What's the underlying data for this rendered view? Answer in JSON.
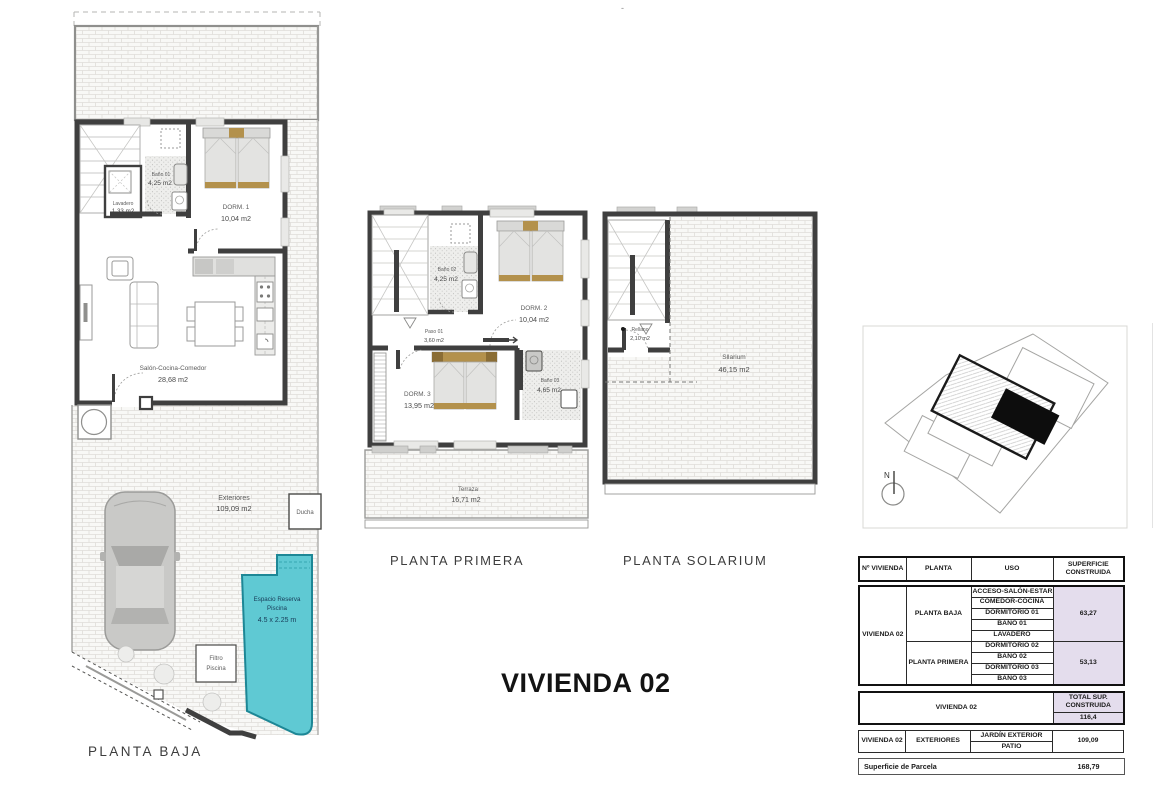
{
  "page": {
    "title": "VIVIENDA 02",
    "top_mark": "-"
  },
  "planta_baja": {
    "label": "PLANTA BAJA",
    "bano01_name": "Baño 01",
    "bano01_area": "4,25 m2",
    "lavadero_name": "Lavadero",
    "lavadero_area": "1,33 m2",
    "dorm1_name": "DORM. 1",
    "dorm1_area": "10,04 m2",
    "salon_name": "Salón-Cocina-Comedor",
    "salon_area": "28,68 m2",
    "exteriores_name": "Exteriores",
    "exteriores_area": "109,09 m2",
    "ducha_label": "Ducha",
    "piscina_line1": "Espacio Reserva",
    "piscina_line2": "Piscina",
    "piscina_dims": "4.5 x 2.25 m",
    "filtro_line1": "Filtro",
    "filtro_line2": "Piscina"
  },
  "planta_primera": {
    "label": "PLANTA PRIMERA",
    "bano02_name": "Baño 02",
    "bano02_area": "4,25 m2",
    "dorm2_name": "DORM. 2",
    "dorm2_area": "10,04 m2",
    "paso_name": "Paso 01",
    "paso_area": "3,60 m2",
    "dorm3_name": "DORM. 3",
    "dorm3_area": "13,95 m2",
    "bano03_name": "Baño 03",
    "bano03_area": "4,65 m2",
    "terraza_name": "Terraza",
    "terraza_area": "16,71 m2"
  },
  "planta_solarium": {
    "label": "PLANTA SOLARIUM",
    "rellano_name": "Rellano",
    "rellano_area": "2,10 m2",
    "solarium_name": "Sllarium",
    "solarium_area": "46,15 m2"
  },
  "site_plan": {
    "north_label": "N"
  },
  "table": {
    "headers": {
      "vivienda": "Nº VIVIENDA",
      "planta": "PLANTA",
      "uso": "USO",
      "superficie": "SUPERFICIE CONSTRUIDA"
    },
    "vivienda_id": "VIVIENDA 02",
    "baja_label": "PLANTA BAJA",
    "baja_usos": [
      "ACCESO-SALÓN-ESTAR",
      "COMEDOR-COCINA",
      "DORMITORIO 01",
      "BAÑO 01",
      "LAVADERO"
    ],
    "baja_superficie": "63,27",
    "primera_label": "PLANTA PRIMERA",
    "primera_usos": [
      "DORMITORIO 02",
      "BAÑO 02",
      "DORMITORIO 03",
      "BAÑO 03"
    ],
    "primera_superficie": "53,13",
    "total_row_label": "VIVIENDA 02",
    "total_header": "TOTAL SUP. CONSTRUIDA",
    "total_value": "116,4",
    "ext_vivienda": "VIVIENDA 02",
    "ext_label": "EXTERIORES",
    "ext_usos": [
      "JARDÍN EXTERIOR",
      "PATIO"
    ],
    "ext_superficie": "109,09",
    "parcela_label": "Superficie de Parcela",
    "parcela_value": "168,79"
  },
  "colors": {
    "pool": "#5fc9d3",
    "pool_border": "#1d8796",
    "tan": "#b3914c",
    "highlight": "#e4dded",
    "wall": "#3f3f3f"
  }
}
